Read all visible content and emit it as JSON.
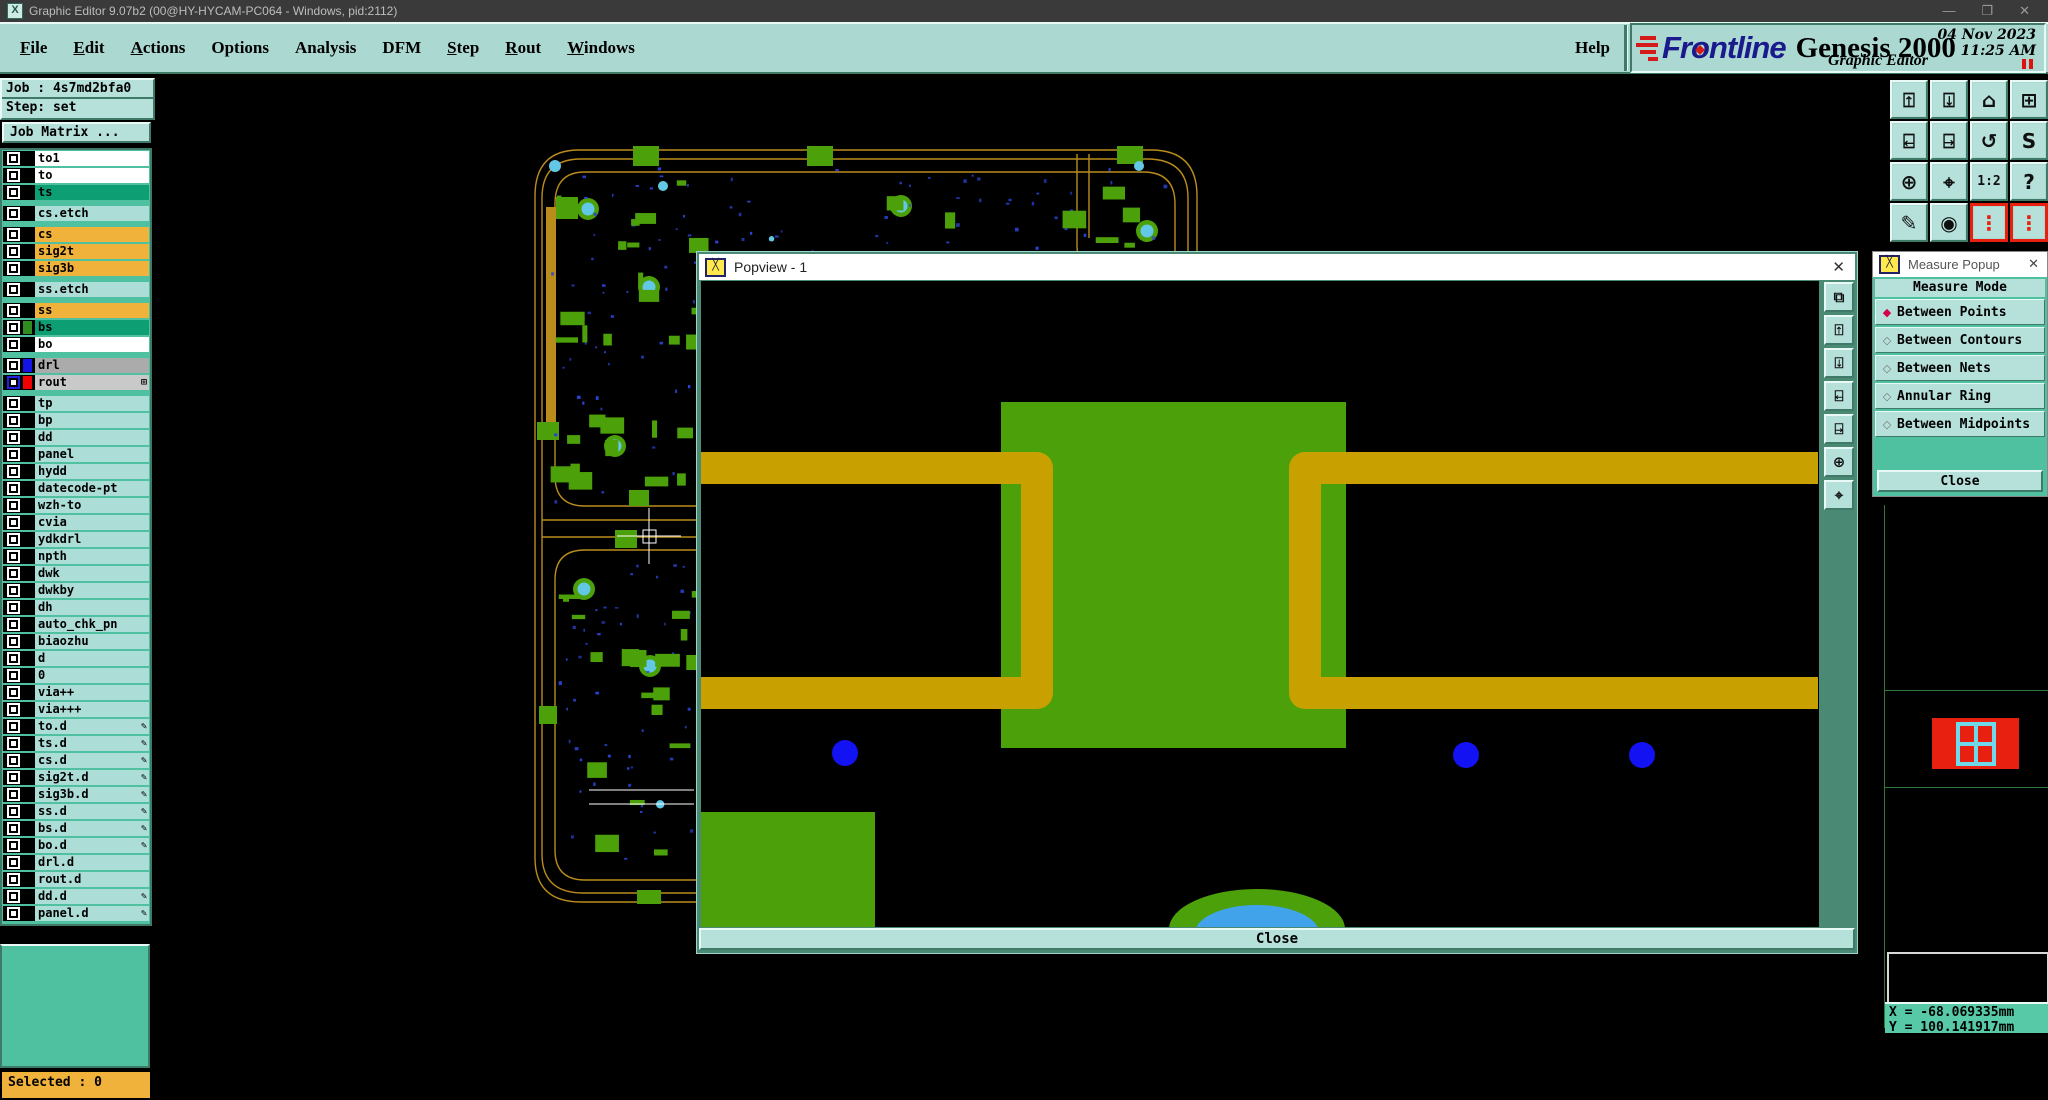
{
  "window": {
    "title": "Graphic Editor 9.07b2 (00@HY-HYCAM-PC064 - Windows, pid:2112)",
    "controls": {
      "minimize": "—",
      "maximize": "❐",
      "close": "✕"
    },
    "app_icon_glyph": "X"
  },
  "menubar": {
    "items": [
      {
        "label": "File",
        "accel": 0
      },
      {
        "label": "Edit",
        "accel": 0
      },
      {
        "label": "Actions",
        "accel": 0
      },
      {
        "label": "Options",
        "accel": -1
      },
      {
        "label": "Analysis",
        "accel": -1
      },
      {
        "label": "DFM",
        "accel": -1
      },
      {
        "label": "Step",
        "accel": 0
      },
      {
        "label": "Rout",
        "accel": 0
      },
      {
        "label": "Windows",
        "accel": 0
      }
    ],
    "help": "Help"
  },
  "brand": {
    "logo_pre": "Fr",
    "logo_o": "o",
    "logo_post": "ntline",
    "product": "Genesis 2000",
    "date": "04 Nov 2023",
    "time": "11:25 AM",
    "subtitle": "Graphic Editor"
  },
  "sidebar": {
    "job": "Job : 4s7md2bfa0",
    "step": "Step: set",
    "job_matrix": "Job Matrix ...",
    "selected": "Selected : 0",
    "layers": [
      {
        "name": "to1",
        "style": "white"
      },
      {
        "name": "to",
        "style": "white"
      },
      {
        "name": "ts",
        "style": "green"
      },
      {
        "name": "cs.etch",
        "style": "cyan",
        "gap": true
      },
      {
        "name": "cs",
        "style": "orange",
        "gap": true
      },
      {
        "name": "sig2t",
        "style": "orange"
      },
      {
        "name": "sig3b",
        "style": "orange"
      },
      {
        "name": "ss.etch",
        "style": "cyan",
        "gap": true
      },
      {
        "name": "ss",
        "style": "orange",
        "gap": true
      },
      {
        "name": "bs",
        "style": "green",
        "swatch": "green"
      },
      {
        "name": "bo",
        "style": "white"
      },
      {
        "name": "drl",
        "style": "gray",
        "swatch": "blue",
        "gap": true
      },
      {
        "name": "rout",
        "style": "lightgray",
        "swatch": "red",
        "grid_icon": true,
        "work": true
      },
      {
        "name": "tp",
        "style": "cyan",
        "gap": true
      },
      {
        "name": "bp",
        "style": "cyan"
      },
      {
        "name": "dd",
        "style": "cyan"
      },
      {
        "name": "panel",
        "style": "cyan"
      },
      {
        "name": "hydd",
        "style": "cyan"
      },
      {
        "name": "datecode-pt",
        "style": "cyan"
      },
      {
        "name": "wzh-to",
        "style": "cyan"
      },
      {
        "name": "cvia",
        "style": "cyan"
      },
      {
        "name": "ydkdrl",
        "style": "cyan"
      },
      {
        "name": "npth",
        "style": "cyan"
      },
      {
        "name": "dwk",
        "style": "cyan"
      },
      {
        "name": "dwkby",
        "style": "cyan"
      },
      {
        "name": "dh",
        "style": "cyan"
      },
      {
        "name": "auto_chk_pn",
        "style": "cyan"
      },
      {
        "name": "biaozhu",
        "style": "cyan"
      },
      {
        "name": "d",
        "style": "cyan"
      },
      {
        "name": "0",
        "style": "cyan"
      },
      {
        "name": "via++",
        "style": "cyan"
      },
      {
        "name": "via+++",
        "style": "cyan"
      },
      {
        "name": "to.d",
        "style": "cyan",
        "dot": true
      },
      {
        "name": "ts.d",
        "style": "cyan",
        "dot": true
      },
      {
        "name": "cs.d",
        "style": "cyan",
        "dot": true
      },
      {
        "name": "sig2t.d",
        "style": "cyan",
        "dot": true
      },
      {
        "name": "sig3b.d",
        "style": "cyan",
        "dot": true
      },
      {
        "name": "ss.d",
        "style": "cyan",
        "dot": true
      },
      {
        "name": "bs.d",
        "style": "cyan",
        "dot": true
      },
      {
        "name": "bo.d",
        "style": "cyan",
        "dot": true
      },
      {
        "name": "drl.d",
        "style": "cyan"
      },
      {
        "name": "rout.d",
        "style": "cyan"
      },
      {
        "name": "dd.d",
        "style": "cyan",
        "dot": true
      },
      {
        "name": "panel.d",
        "style": "cyan",
        "dot": true
      }
    ],
    "grid_icon_glyph": "⊞",
    "dot_icon_glyph": "✎"
  },
  "toolbar": [
    {
      "name": "view-up",
      "glyph": "⍐"
    },
    {
      "name": "view-down",
      "glyph": "⍗"
    },
    {
      "name": "home-view",
      "glyph": "⌂"
    },
    {
      "name": "window-xy",
      "glyph": "⊞"
    },
    {
      "name": "view-left",
      "glyph": "⍇"
    },
    {
      "name": "view-right",
      "glyph": "⍈"
    },
    {
      "name": "previous-view",
      "glyph": "↺"
    },
    {
      "name": "redraw-s",
      "glyph": "S"
    },
    {
      "name": "zoom-fit",
      "glyph": "⊕"
    },
    {
      "name": "zoom-center",
      "glyph": "⌖"
    },
    {
      "name": "zoom-1-2",
      "glyph": "1:2",
      "small": true
    },
    {
      "name": "query",
      "glyph": "?"
    },
    {
      "name": "edit-tools",
      "glyph": "✎"
    },
    {
      "name": "snap-origin",
      "glyph": "◉"
    },
    {
      "name": "net-highlight-a",
      "glyph": "⋮",
      "red": true
    },
    {
      "name": "net-highlight-b",
      "glyph": "⋮",
      "red": true
    }
  ],
  "popview": {
    "title": "Popview - 1",
    "close_x": "✕",
    "close_button": "Close",
    "side_buttons": [
      {
        "name": "popview-clone",
        "glyph": "⧉"
      },
      {
        "name": "popview-zoom-in",
        "glyph": "⍐"
      },
      {
        "name": "popview-zoom-out",
        "glyph": "⍗"
      },
      {
        "name": "popview-pan-left",
        "glyph": "⍇"
      },
      {
        "name": "popview-pan-right",
        "glyph": "⍈"
      },
      {
        "name": "popview-fit",
        "glyph": "⊕"
      },
      {
        "name": "popview-center",
        "glyph": "⌖"
      }
    ]
  },
  "measure": {
    "title": "Measure Popup",
    "close_x": "✕",
    "header": "Measure Mode",
    "options": [
      {
        "label": "Between Points",
        "selected": true
      },
      {
        "label": "Between Contours",
        "selected": false
      },
      {
        "label": "Between Nets",
        "selected": false
      },
      {
        "label": "Annular Ring",
        "selected": false
      },
      {
        "label": "Between Midpoints",
        "selected": false
      }
    ],
    "close_button": "Close"
  },
  "status": {
    "x": "X = -68.069335mm",
    "y": "Y = 100.141917mm"
  },
  "colors": {
    "teal_bg": "#abd9d1",
    "teal_btn": "#b6e0da",
    "bevel_light": "#e9f9f5",
    "bevel_dark": "#3f7a69",
    "teal_mid": "#4fc1a1",
    "row_cyan": "#acddd7",
    "row_orange": "#f0b23a",
    "row_green": "#0d9e74",
    "row_gray": "#ababab",
    "row_lightgray": "#c9c9c9",
    "swatch_green": "#2f8c1f",
    "swatch_blue": "#1414e8",
    "swatch_red": "#f00000",
    "trace_gold": "#c8a000",
    "outline_gold": "#ba8c1c",
    "pad_green": "#4ca00a",
    "via_cyan": "#62c8e6",
    "tiny_blue": "#2b44d4",
    "dot_blue": "#1212f2",
    "arc_blue": "#41a3e9",
    "accent_red": "#e82010",
    "diamond_red": "#d4004c",
    "coord_teal": "#57c9a7"
  }
}
